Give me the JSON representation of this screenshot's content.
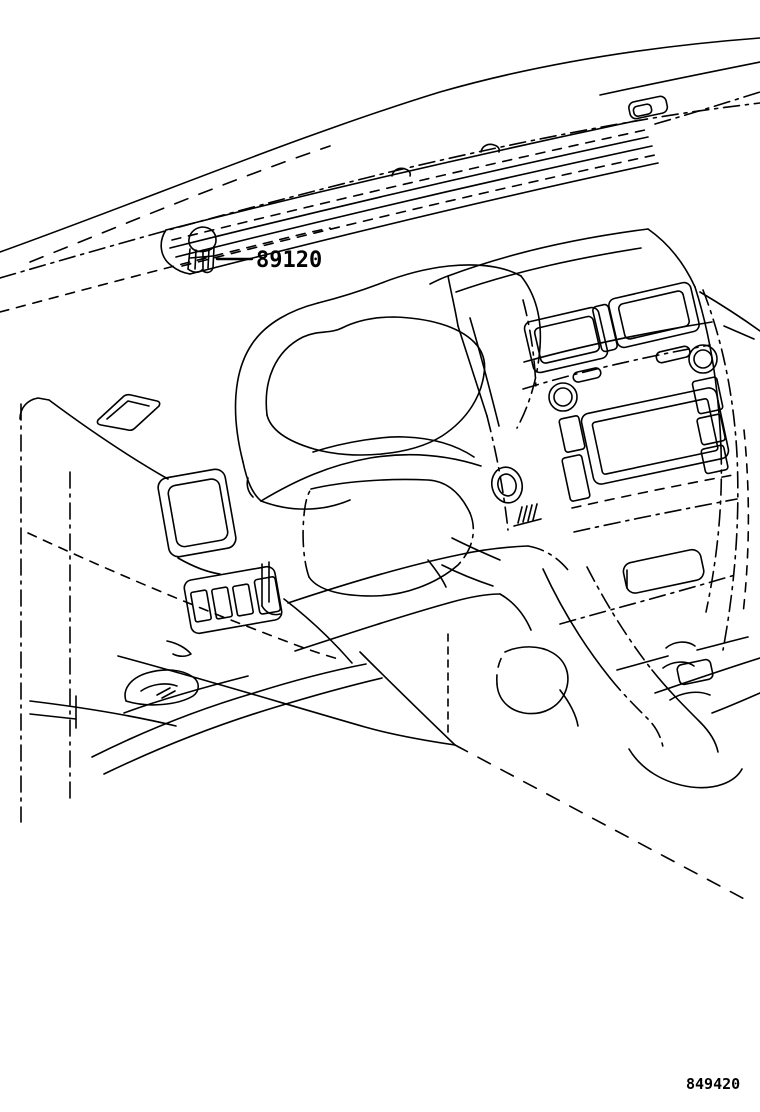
{
  "diagram": {
    "background_color": "#ffffff",
    "line_color": "#000000",
    "callout": {
      "part_number": "89120"
    },
    "drawing_number": "849420"
  }
}
